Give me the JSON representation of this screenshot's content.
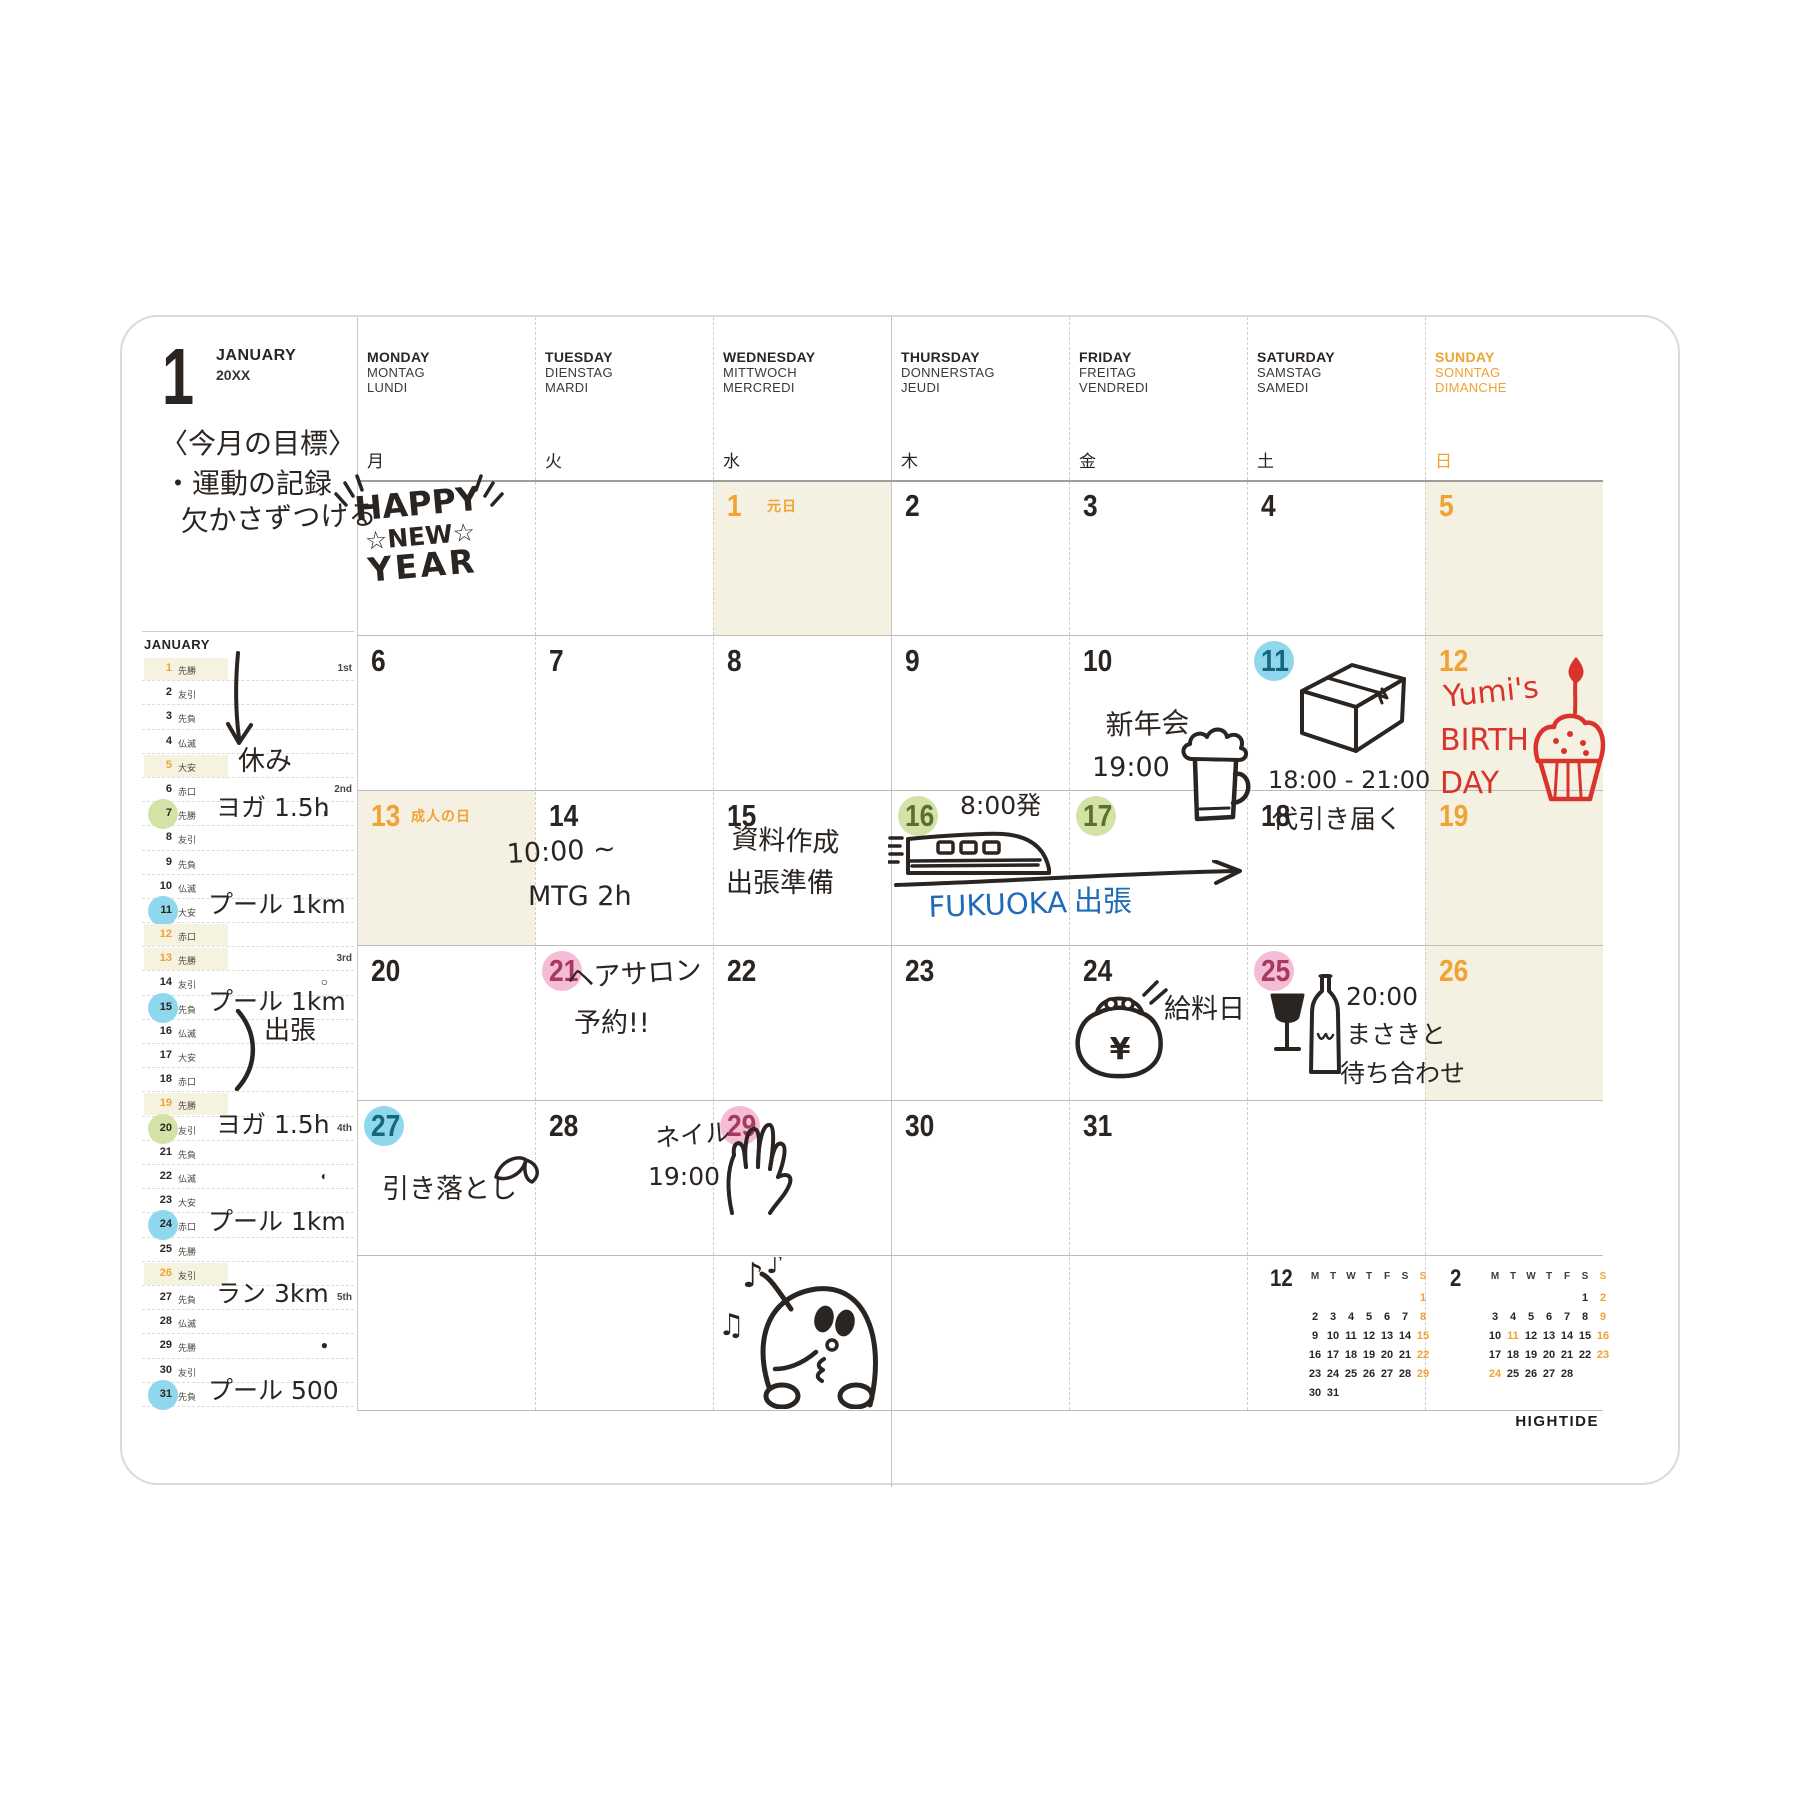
{
  "page": {
    "month_number": "1",
    "month_name": "JANUARY",
    "year": "20XX",
    "logo": "HIGHTIDE"
  },
  "colors": {
    "orange": "#F0A232",
    "cream": "#F5F1E2",
    "blue": "#8FD7EC",
    "green": "#D3E3A6",
    "pink": "#F4BCD5",
    "red": "#D8342C",
    "blue_ink": "#1E6BB8",
    "ink": "#2b2522",
    "num_on_blue": "#17677C",
    "num_on_green": "#5E6E33",
    "num_on_pink": "#A63A5E"
  },
  "day_headers": [
    {
      "en": "MONDAY",
      "de": "MONTAG",
      "fr": "LUNDI",
      "jp": "月",
      "color": "ink"
    },
    {
      "en": "TUESDAY",
      "de": "DIENSTAG",
      "fr": "MARDI",
      "jp": "火",
      "color": "ink"
    },
    {
      "en": "WEDNESDAY",
      "de": "MITTWOCH",
      "fr": "MERCREDI",
      "jp": "水",
      "color": "ink"
    },
    {
      "en": "THURSDAY",
      "de": "DONNERSTAG",
      "fr": "JEUDI",
      "jp": "木",
      "color": "ink"
    },
    {
      "en": "FRIDAY",
      "de": "FREITAG",
      "fr": "VENDREDI",
      "jp": "金",
      "color": "ink"
    },
    {
      "en": "SATURDAY",
      "de": "SAMSTAG",
      "fr": "SAMEDI",
      "jp": "土",
      "color": "ink"
    },
    {
      "en": "SUNDAY",
      "de": "SONNTAG",
      "fr": "DIMANCHE",
      "jp": "日",
      "color": "orange"
    }
  ],
  "goal": [
    "〈今月の目標〉",
    "・運動の記録",
    "欠かさずつける"
  ],
  "hny": {
    "line1": "HAPPY",
    "line2": "☆NEW☆",
    "line3": "YEAR"
  },
  "doodle_text": {
    "yen": "¥",
    "note1": "♪",
    "note2": "♫",
    "note3": "♪"
  },
  "sidebar": {
    "title": "JANUARY",
    "rows": [
      {
        "d": "1",
        "r": "先勝",
        "hl": true,
        "marker": "1st"
      },
      {
        "d": "2",
        "r": "友引"
      },
      {
        "d": "3",
        "r": "先負"
      },
      {
        "d": "4",
        "r": "仏滅"
      },
      {
        "d": "5",
        "r": "大安",
        "hl": true
      },
      {
        "d": "6",
        "r": "赤口",
        "marker": "2nd"
      },
      {
        "d": "7",
        "r": "先勝",
        "circle": "green",
        "moon": "◑"
      },
      {
        "d": "8",
        "r": "友引"
      },
      {
        "d": "9",
        "r": "先負"
      },
      {
        "d": "10",
        "r": "仏滅"
      },
      {
        "d": "11",
        "r": "大安",
        "circle": "blue"
      },
      {
        "d": "12",
        "r": "赤口",
        "hl": true
      },
      {
        "d": "13",
        "r": "先勝",
        "hl": true,
        "marker": "3rd"
      },
      {
        "d": "14",
        "r": "友引",
        "moon": "○"
      },
      {
        "d": "15",
        "r": "先負",
        "circle": "blue"
      },
      {
        "d": "16",
        "r": "仏滅"
      },
      {
        "d": "17",
        "r": "大安"
      },
      {
        "d": "18",
        "r": "赤口"
      },
      {
        "d": "19",
        "r": "先勝",
        "hl": true
      },
      {
        "d": "20",
        "r": "友引",
        "circle": "green",
        "marker": "4th"
      },
      {
        "d": "21",
        "r": "先負"
      },
      {
        "d": "22",
        "r": "仏滅",
        "moon": "◐"
      },
      {
        "d": "23",
        "r": "大安"
      },
      {
        "d": "24",
        "r": "赤口",
        "circle": "blue"
      },
      {
        "d": "25",
        "r": "先勝"
      },
      {
        "d": "26",
        "r": "友引",
        "hl": true
      },
      {
        "d": "27",
        "r": "先負",
        "marker": "5th"
      },
      {
        "d": "28",
        "r": "仏滅"
      },
      {
        "d": "29",
        "r": "先勝",
        "moon": "●"
      },
      {
        "d": "30",
        "r": "友引"
      },
      {
        "d": "31",
        "r": "先負",
        "circle": "blue"
      }
    ]
  },
  "calendar": {
    "weeks": [
      [
        {},
        {},
        {
          "d": "1",
          "orange": true,
          "cream": true,
          "holiday": "元日"
        },
        {
          "d": "2"
        },
        {
          "d": "3"
        },
        {
          "d": "4"
        },
        {
          "d": "5",
          "orange": true,
          "cream": true
        }
      ],
      [
        {
          "d": "6"
        },
        {
          "d": "7"
        },
        {
          "d": "8"
        },
        {
          "d": "9"
        },
        {
          "d": "10"
        },
        {
          "d": "11",
          "circle": "blue"
        },
        {
          "d": "12",
          "orange": true,
          "cream": true
        }
      ],
      [
        {
          "d": "13",
          "orange": true,
          "cream": true,
          "holiday": "成人の日"
        },
        {
          "d": "14"
        },
        {
          "d": "15"
        },
        {
          "d": "16",
          "circle": "green"
        },
        {
          "d": "17",
          "circle": "green"
        },
        {
          "d": "18"
        },
        {
          "d": "19",
          "orange": true,
          "cream": true
        }
      ],
      [
        {
          "d": "20"
        },
        {
          "d": "21",
          "circle": "pink"
        },
        {
          "d": "22"
        },
        {
          "d": "23"
        },
        {
          "d": "24"
        },
        {
          "d": "25",
          "circle": "pink"
        },
        {
          "d": "26",
          "orange": true,
          "cream": true
        }
      ],
      [
        {
          "d": "27",
          "circle": "blue"
        },
        {
          "d": "28"
        },
        {
          "d": "29",
          "circle": "pink"
        },
        {
          "d": "30"
        },
        {
          "d": "31"
        },
        {},
        {}
      ],
      [
        {},
        {},
        {},
        {},
        {},
        {},
        {}
      ]
    ]
  },
  "handwriting": [
    {
      "name": "goal-line-1",
      "x": 38,
      "y": 112,
      "size": 28,
      "text": "〈今月の目標〉"
    },
    {
      "name": "goal-line-2",
      "x": 42,
      "y": 152,
      "size": 28,
      "text": "・運動の記録"
    },
    {
      "name": "goal-line-3",
      "x": 58,
      "y": 190,
      "size": 28,
      "rotate": -2,
      "text": "欠かさずつける"
    },
    {
      "name": "happy-new-year-doodle",
      "doodle": "happy-new-year",
      "x": 210,
      "y": 146,
      "w": 175,
      "h": 125
    },
    {
      "name": "arrow-down-doodle",
      "doodle": "arrow-down",
      "x": 100,
      "y": 333,
      "w": 36,
      "h": 105
    },
    {
      "name": "note-holiday",
      "x": 116,
      "y": 430,
      "size": 27,
      "text": "休み"
    },
    {
      "name": "note-yoga-1",
      "x": 94,
      "y": 477,
      "size": 25,
      "text": "ヨガ 1.5h"
    },
    {
      "name": "note-pool-1",
      "x": 86,
      "y": 574,
      "size": 25,
      "text": "プール 1km"
    },
    {
      "name": "note-pool-2",
      "x": 86,
      "y": 671,
      "size": 25,
      "text": "プール 1km"
    },
    {
      "name": "brace-doodle",
      "doodle": "brace",
      "x": 110,
      "y": 692,
      "w": 28,
      "h": 82
    },
    {
      "name": "note-trip",
      "x": 142,
      "y": 700,
      "size": 26,
      "text": "出張"
    },
    {
      "name": "note-yoga-2",
      "x": 94,
      "y": 794,
      "size": 25,
      "text": "ヨガ 1.5h"
    },
    {
      "name": "note-pool-3",
      "x": 86,
      "y": 891,
      "size": 25,
      "text": "プール 1km"
    },
    {
      "name": "note-run",
      "x": 94,
      "y": 963,
      "size": 25,
      "text": "ラン 3km"
    },
    {
      "name": "note-pool-4",
      "x": 86,
      "y": 1060,
      "size": 25,
      "text": "プール 500"
    },
    {
      "name": "entry-newyear-party",
      "x": 983,
      "y": 394,
      "size": 28,
      "rotate": -2,
      "text": "新年会"
    },
    {
      "name": "entry-newyear-party-time",
      "x": 970,
      "y": 436,
      "size": 27,
      "text": "19:00"
    },
    {
      "name": "beer-mug-doodle",
      "doodle": "beer-mug",
      "x": 1056,
      "y": 402,
      "w": 78,
      "h": 110
    },
    {
      "name": "box-doodle",
      "doodle": "box",
      "x": 1172,
      "y": 336,
      "w": 118,
      "h": 108
    },
    {
      "name": "entry-delivery-time",
      "x": 1146,
      "y": 450,
      "size": 24,
      "text": "18:00 - 21:00"
    },
    {
      "name": "entry-delivery",
      "x": 1150,
      "y": 489,
      "size": 26,
      "text": "代引き届く"
    },
    {
      "name": "entry-birthday-1",
      "x": 1320,
      "y": 364,
      "size": 30,
      "color": "red",
      "rotate": -6,
      "text": "Yumi's"
    },
    {
      "name": "entry-birthday-2",
      "x": 1318,
      "y": 407,
      "size": 30,
      "color": "red",
      "text": "BIRTH"
    },
    {
      "name": "entry-birthday-3",
      "x": 1318,
      "y": 450,
      "size": 30,
      "color": "red",
      "text": "DAY"
    },
    {
      "name": "cupcake-doodle",
      "doodle": "cupcake",
      "x": 1404,
      "y": 340,
      "w": 88,
      "h": 150
    },
    {
      "name": "entry-mtg-time",
      "x": 384,
      "y": 523,
      "size": 27,
      "rotate": -3,
      "text": "10:00 ~"
    },
    {
      "name": "entry-mtg",
      "x": 406,
      "y": 565,
      "size": 27,
      "text": "MTG 2h"
    },
    {
      "name": "entry-docs",
      "x": 610,
      "y": 508,
      "size": 27,
      "rotate": 2,
      "text": "資料作成"
    },
    {
      "name": "entry-trip-prep",
      "x": 604,
      "y": 552,
      "size": 27,
      "text": "出張準備"
    },
    {
      "name": "entry-depart",
      "x": 838,
      "y": 475,
      "size": 25,
      "text": "8:00発"
    },
    {
      "name": "train-doodle",
      "doodle": "train",
      "x": 766,
      "y": 497,
      "w": 170,
      "h": 82
    },
    {
      "name": "arrow-long-doodle",
      "doodle": "arrow-long",
      "x": 772,
      "y": 543,
      "w": 358,
      "h": 32
    },
    {
      "name": "entry-fukuoka",
      "x": 806,
      "y": 575,
      "size": 29,
      "color": "blue",
      "rotate": -2,
      "text": "FUKUOKA"
    },
    {
      "name": "entry-fukuoka-trip",
      "x": 952,
      "y": 569,
      "size": 29,
      "color": "blue",
      "text": "出張"
    },
    {
      "name": "entry-hairsalon",
      "x": 444,
      "y": 648,
      "size": 27,
      "rotate": -4,
      "text": "ヘアサロン"
    },
    {
      "name": "entry-hairsalon-2",
      "x": 452,
      "y": 692,
      "size": 27,
      "text": "予約!!"
    },
    {
      "name": "purse-doodle",
      "doodle": "purse",
      "x": 948,
      "y": 662,
      "w": 100,
      "h": 100
    },
    {
      "name": "entry-payday",
      "x": 1042,
      "y": 678,
      "size": 27,
      "text": "給料日"
    },
    {
      "name": "wine-doodle",
      "doodle": "wine",
      "x": 1146,
      "y": 655,
      "w": 78,
      "h": 112
    },
    {
      "name": "entry-meet-time",
      "x": 1224,
      "y": 666,
      "size": 25,
      "text": "20:00"
    },
    {
      "name": "entry-meet-1",
      "x": 1224,
      "y": 704,
      "size": 25,
      "text": "まさきと"
    },
    {
      "name": "entry-meet-2",
      "x": 1218,
      "y": 743,
      "size": 25,
      "text": "待ち合わせ"
    },
    {
      "name": "entry-debit",
      "x": 260,
      "y": 858,
      "size": 27,
      "text": "引き落とし"
    },
    {
      "name": "bean-doodle",
      "doodle": "bean",
      "x": 366,
      "y": 832,
      "w": 58,
      "h": 40
    },
    {
      "name": "entry-nail",
      "x": 532,
      "y": 808,
      "size": 25,
      "rotate": -5,
      "text": "ネイル"
    },
    {
      "name": "entry-nail-time",
      "x": 526,
      "y": 846,
      "size": 25,
      "text": "19:00"
    },
    {
      "name": "hand-doodle",
      "doodle": "hand",
      "x": 596,
      "y": 794,
      "w": 80,
      "h": 105
    },
    {
      "name": "penguin-doodle",
      "doodle": "penguin",
      "x": 596,
      "y": 940,
      "w": 195,
      "h": 152
    }
  ],
  "mini_calendars": [
    {
      "month": "12",
      "days": [
        "M",
        "T",
        "W",
        "T",
        "F",
        "S",
        "S"
      ],
      "weeks": [
        [
          "",
          "",
          "",
          "",
          "",
          "",
          "1"
        ],
        [
          "2",
          "3",
          "4",
          "5",
          "6",
          "7",
          "8"
        ],
        [
          "9",
          "10",
          "11",
          "12",
          "13",
          "14",
          "15"
        ],
        [
          "16",
          "17",
          "18",
          "19",
          "20",
          "21",
          "22"
        ],
        [
          "23",
          "24",
          "25",
          "26",
          "27",
          "28",
          "29"
        ],
        [
          "30",
          "31",
          "",
          "",
          "",
          "",
          ""
        ]
      ],
      "orange": [
        "1",
        "8",
        "15",
        "22",
        "29"
      ]
    },
    {
      "month": "2",
      "days": [
        "M",
        "T",
        "W",
        "T",
        "F",
        "S",
        "S"
      ],
      "weeks": [
        [
          "",
          "",
          "",
          "",
          "",
          "1",
          "2"
        ],
        [
          "3",
          "4",
          "5",
          "6",
          "7",
          "8",
          "9"
        ],
        [
          "10",
          "11",
          "12",
          "13",
          "14",
          "15",
          "16"
        ],
        [
          "17",
          "18",
          "19",
          "20",
          "21",
          "22",
          "23"
        ],
        [
          "24",
          "25",
          "26",
          "27",
          "28",
          "",
          ""
        ]
      ],
      "orange": [
        "2",
        "9",
        "16",
        "23",
        "11",
        "24"
      ]
    }
  ]
}
